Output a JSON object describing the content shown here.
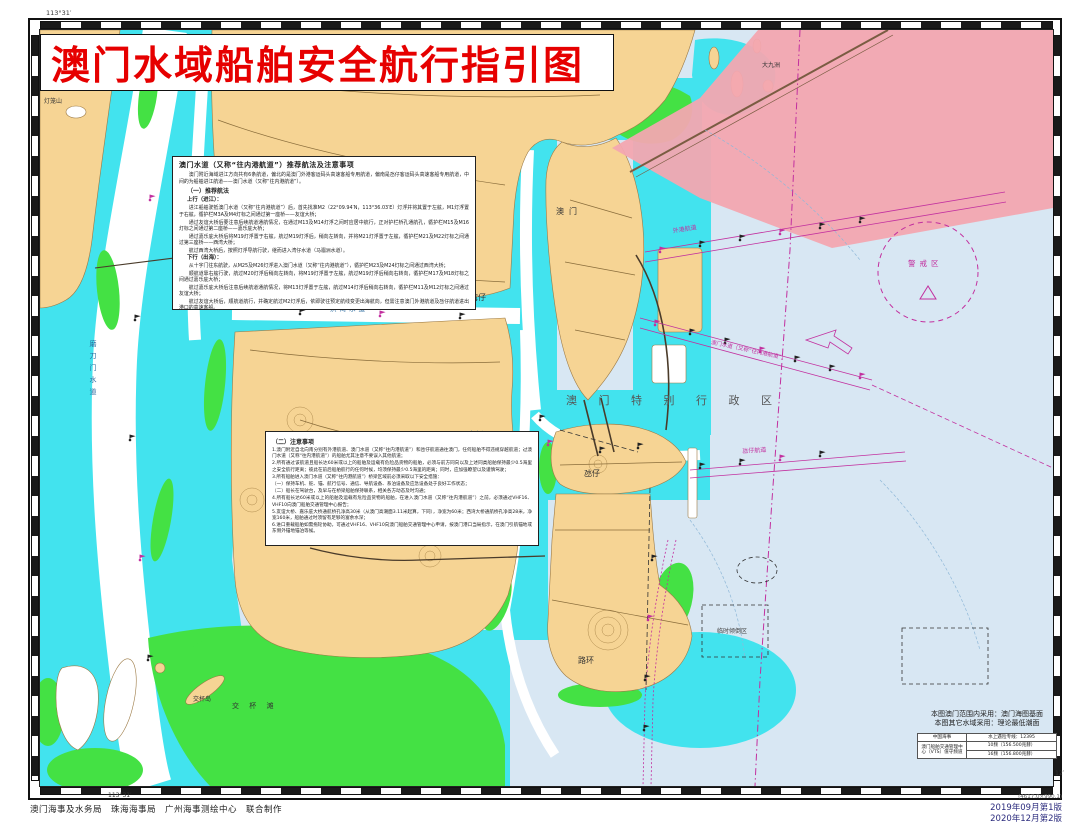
{
  "title": "澳门水域船舶安全航行指引图",
  "colors": {
    "title_red": "#e60000",
    "land_tan": "#f6d494",
    "shallow_cyan": "#42e3ee",
    "tidal_green": "#44e144",
    "open_water": "#d8e7f3",
    "restricted_pink": "#f3a6b0",
    "magenta": "#c2309f"
  },
  "guidance": {
    "heading": "澳门水道（又称“往内港航道”）推荐航法及注意事项",
    "intro": "澳门附近海域进江方向共有6条航道，偏北的是澳门外港客运码头高速客船专用航道，偏南是氹仔客运码头高速客船专用航道，中间的为船舶进江航道——澳门水道（又称“往内港航道”）。",
    "s1": "（一）推荐航法",
    "up_heading": "上行（进江）：",
    "up": [
      "进江船舶驶抵澳门水道（又称“往内港航道”）后，首先找准M2（22°09.94′N，113°36.03′E）灯浮并将其置于左舷，M1灯浮置于右舷，循护栏M3A及M4灯标之间通过第一座桥——友谊大桥；",
      "通过友谊大桥后要注意后续航道通航情况，在通过M13及M14灯浮之间时应居中航行，正对护栏桥孔通航孔，循护栏M15及M16灯标之间通过第二座桥——嘉乐庇大桥；",
      "通过嘉乐庇大桥后将M19灯浮置于右舷，航过M19灯浮后，稍向左转向，并将M21灯浮置于左舷，循护栏M21及M22灯标之间通过第三座桥——西湾大桥；",
      "航过西湾大桥后，按照灯浮导航行驶，继而进入湾仔水道（马骝洲水道）。"
    ],
    "down_heading": "下行（出海）：",
    "down": [
      "从十字门往东航驶，从M25及M26灯浮进入澳门水道（又称“往内港航道”），循护栏M23及M24灯标之间通过西湾大桥；",
      "顺航道靠右舷行驶，航过M20灯浮后稍向左转向，将M19灯浮置于左舷，航过M19灯浮后稍向右转向，循护栏M17及M18灯标之间通过嘉乐庇大桥；",
      "航过嘉乐庇大桥后注意后续航道通航情况，将M13灯浮置于左舷，航过M14灯浮后稍向右转向，循护栏M11及M12灯标之间通过友谊大桥；",
      "航过友谊大桥后，顺航道航行，并确定航过M2灯浮后，依即驶往预定航线变更出海航向，但需注意澳门外港航道及氹仔航道进出港口的高速客船。"
    ]
  },
  "notice": {
    "heading": "（二）注意事项",
    "items": [
      "1.澳门附近自北向南分别有外港航道、澳门水道（又称“往内港航道”）和氹仔航道通往澳门，任何船舶不得违规穿越航道；过澳门水道（又称“往内港航道”）的船舶尤其注意不要误入其他航道；",
      "2.所有通过该航道且船长达60米或以上的船舶及运载有危险品货物的船舶，必须与前方同向以及上述同类船舶保持最少0.5海里之安全航行距离；彼此在前后船舶航行的任何时候，均须保持最少0.5海里的距离；同时，应加强瞭望以及谨慎驾驶；",
      "3.所有船舶进入澳门水道（又称“往内港航道”）桥梁区域前必须采取以下安全措施：",
      "（一）保持车机、舵、锚、航行信号、通信、导航设备、系泊设备及应急设备处于良好工作状态；",
      "（二）船长在驾驶台，及早与在桥梁船舶保持联系，相关各方动态及时沟通；",
      "4.所有船长达60米或以上的船舶及运载有危险品货物的船舶，在进入澳门水道（又称“往内港航道”）之前，必须通过VHF16、VHF10向澳门船舶交通管理中心报告；",
      "5.友谊大桥、嘉乐庇大桥通航桥孔净高30米（从澳门高潮面3.11米起算，下同），净宽为60米；西湾大桥通航桥孔净高28米，净宽160米，船舶通过时须留有足够的富余水深；",
      "6.进口重载船舶如需拖轮协助，可通过VHF16、VHF10向澳门船舶交通管理中心申请，按澳门港口当局指示，在澳门引航锚地或东侧外锚地锚泊等候。"
    ]
  },
  "map_labels": {
    "sar": "澳 门 特 别 行 政 区",
    "macau": "澳门",
    "wanzai": "湾仔",
    "hengqin": "横琴岛",
    "taipa": "氹仔",
    "coloane": "路环",
    "jiaobei_island": "交杯岛",
    "jiaobei_shoal": "交 杯 滩",
    "precaution_area": "警戒区",
    "dumping_area": "临时倾倒区",
    "dajiuzhou": "大九洲",
    "denglongshan": "灯笼山",
    "modaomen": "磨刀门水道",
    "hongwan": "洪湾水道",
    "shizimen": "十字门",
    "outer_channel": "外港航道",
    "macau_channel": "澳门水道（又称“往内港航道”）",
    "taipa_channel": "氹仔航道"
  },
  "datum_note": {
    "line1": "本图澳门范围内采用：澳门海图基面",
    "line2": "本图其它水域采用：理论最低潮面"
  },
  "contact_table": {
    "r1_label": "中国海事",
    "r1_value": "水上遇险专线：12395",
    "r2_label": "澳门船舶交通管理中心（VTS）值守频道",
    "r2_value1": "10频（156.500兆赫）",
    "r2_value2": "16频（156.800兆赫）"
  },
  "footer": {
    "credits": "澳门海事及水务局　珠海海事局　广州海事测绘中心　联合制作",
    "edition1": "2019年09月第1版",
    "edition2": "2020年12月第2版",
    "plot_note": "(4617.0×990.1)"
  },
  "frame_labels": {
    "lon_top_left": "113°31′",
    "lon_bottom_left": "113°31′",
    "lat_right": "12′"
  }
}
